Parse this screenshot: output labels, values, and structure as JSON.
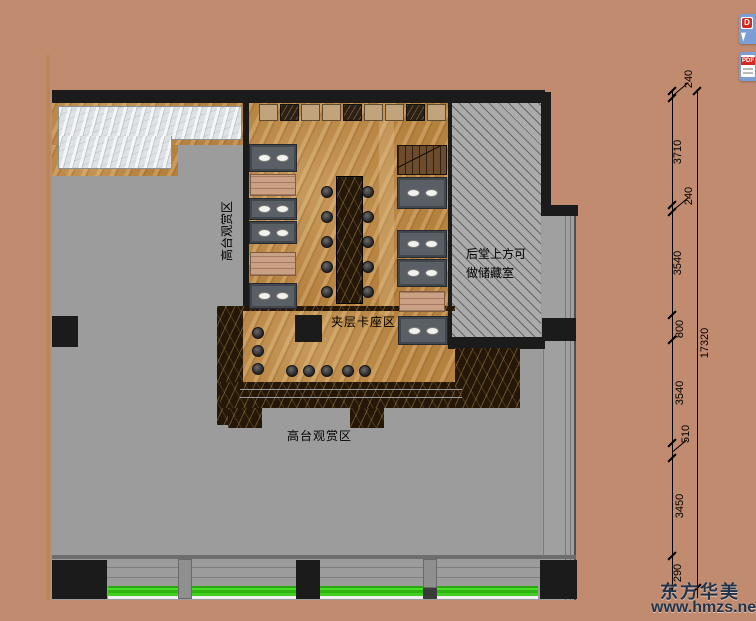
{
  "rooms": {
    "left_area_label_vertical": "高台观赏区",
    "bottom_area_label": "高台观赏区",
    "mezzanine_label": "夹层卡座区",
    "storage_note_line1": "后堂上方可",
    "storage_note_line2": "做储藏室"
  },
  "dimensions": {
    "segments": [
      "240",
      "3710",
      "240",
      "3540",
      "800",
      "3540",
      "510",
      "3450",
      "290"
    ],
    "total": "17320"
  },
  "side_buttons": {
    "download_label": "D",
    "pdf_label": "PDF"
  },
  "watermark": {
    "title": "东方华美",
    "url": "www.hmzs.net"
  }
}
